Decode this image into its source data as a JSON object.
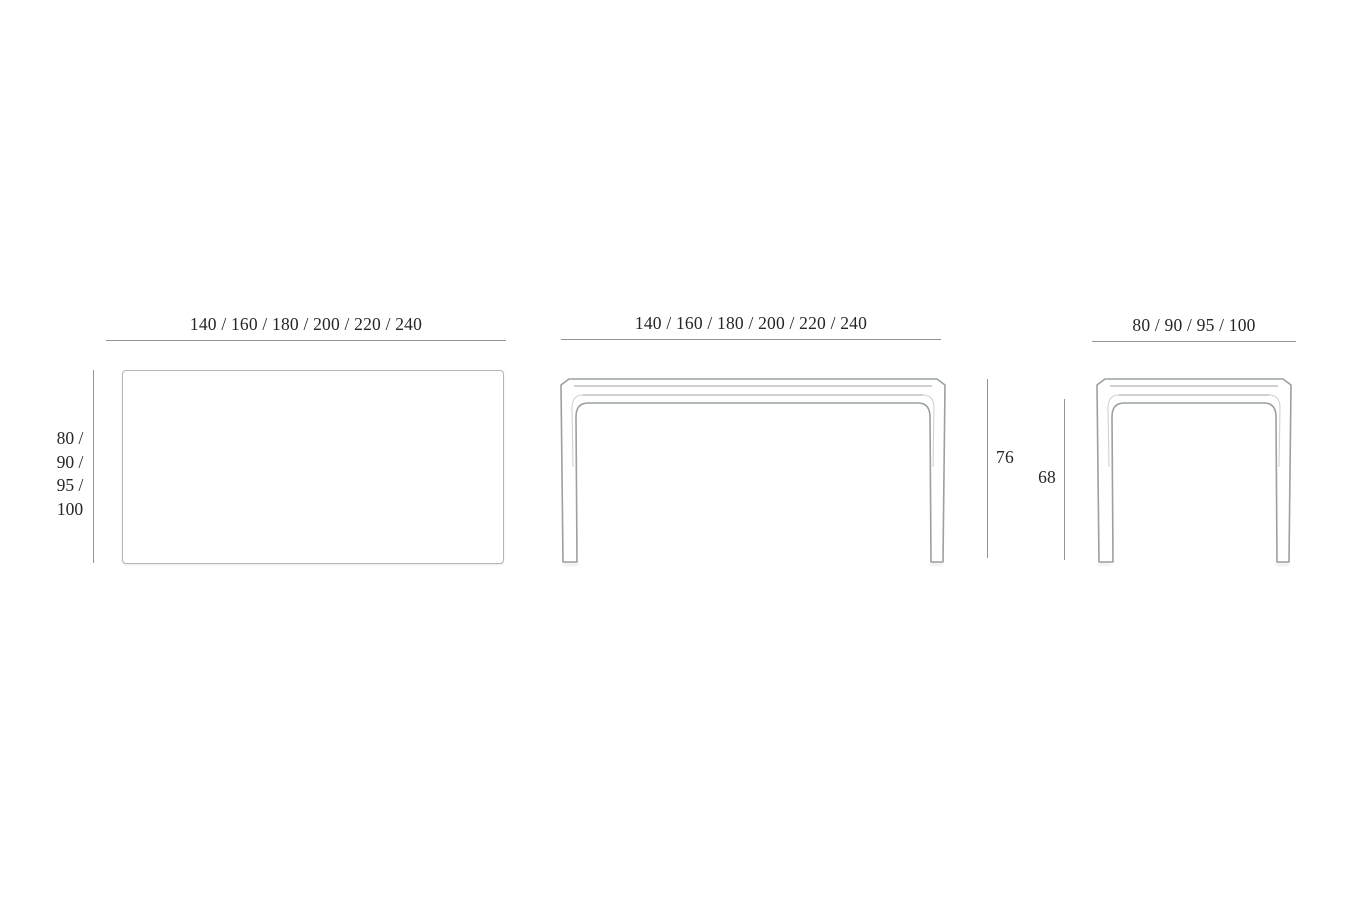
{
  "colors": {
    "background": "#ffffff",
    "dimension_line": "#949494",
    "drawing_outline": "#9aa0a4",
    "drawing_detail": "#b0b4b7",
    "text": "#262626"
  },
  "plan_view": {
    "width_dimension": "140 / 160 / 180 / 200 / 220 / 240",
    "depth_dimension_lines": [
      "80 /",
      "90 /",
      "95 /",
      "100"
    ]
  },
  "front_view": {
    "width_dimension": "140 / 160 / 180 / 200 / 220 / 240",
    "overall_height": "76",
    "clearance_height": "68"
  },
  "side_view": {
    "depth_dimension": "80 / 90 / 95 / 100"
  }
}
